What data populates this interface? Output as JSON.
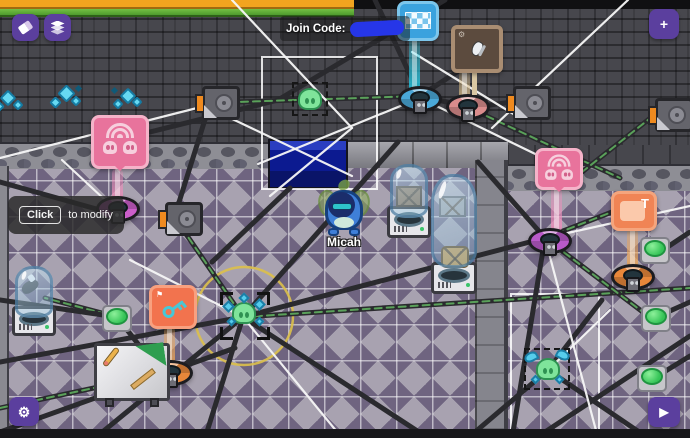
{
  "hud": {
    "join_code_label": "Join Code:",
    "join_code_redacted": true,
    "tooltip": {
      "button_label": "Click",
      "text": "to modify"
    },
    "buttons": {
      "add_label": "+",
      "play_glyph": "▶",
      "settings_glyph": "⚙"
    }
  },
  "player": {
    "name": "Micah"
  },
  "signs": {
    "text_sign_letter": "T",
    "key_sign_flag_glyph": "⚑",
    "brown_sign_gear_glyph": "⚙"
  },
  "icons": {
    "eraser": "css-shape",
    "layers": "css-shape",
    "add": "+",
    "settings_gear": "⚙",
    "play": "▶",
    "checkered_flag": "css-checkerboard",
    "wifi": "css-arcs",
    "skull": "css-shape",
    "key": "css-shape",
    "flag": "⚑",
    "sneaker": "css-shape",
    "letter_T": "T"
  },
  "colors": {
    "hud_purple": "#5b3f9e",
    "sign_pink": "#e8739c",
    "sign_red_orange": "#f2734e",
    "sign_orange": "#f08455",
    "sign_blue": "#3aa2de",
    "sign_brown": "#5c4b3e",
    "button_green": "#35c457",
    "join_code_redaction_blue": "#2636e8",
    "beam_cyan": "#3cdcf0",
    "beam_pink": "#f096be",
    "beam_orange": "#f0aa5a",
    "beam_tan": "#e1c896",
    "floor_diamond_purple": "#6f6480",
    "wall_gray": "#47474d",
    "pool_blue": "#0c1a90"
  }
}
